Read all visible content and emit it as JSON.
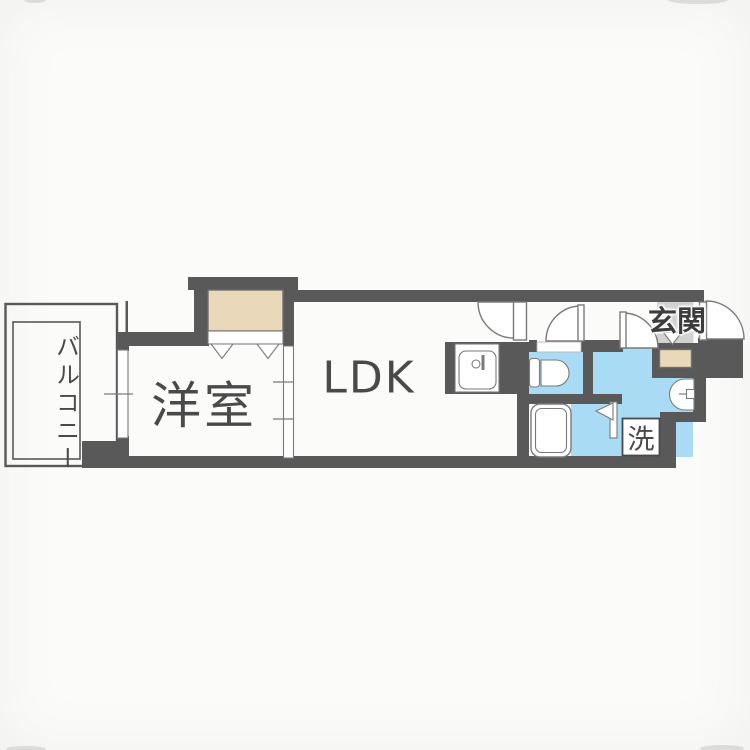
{
  "meta": {
    "kind": "japanese-apartment-floor-plan"
  },
  "colors": {
    "background": "#fbfbfa",
    "wall": "#595959",
    "wet_area": "#a9dcf4",
    "closet": "#ead8bb",
    "entrance_tile": "#d2d2d2",
    "fixture_line": "#7a7a7a",
    "label_text": "#4a4a4a"
  },
  "labels": {
    "balcony": "バルコニー",
    "western_room": "洋室",
    "ldk": "LDK",
    "entrance": "玄関",
    "laundry": "洗"
  }
}
